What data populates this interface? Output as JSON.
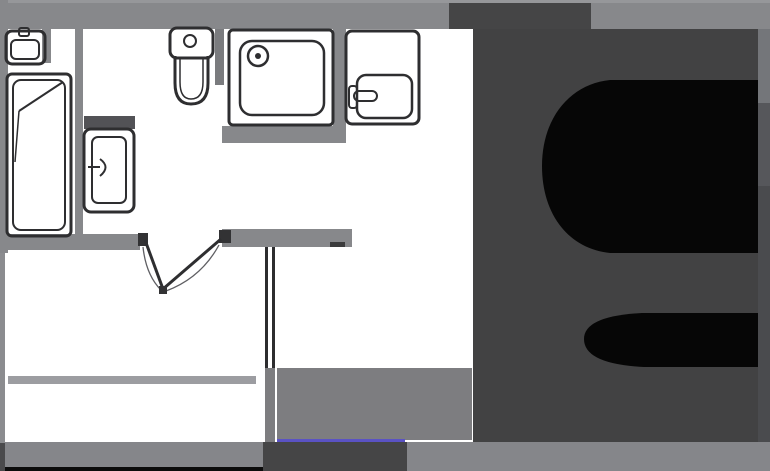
{
  "canvas": {
    "width": 770,
    "height": 471,
    "background": "#ffffff"
  },
  "plan": {
    "description": "apartment-floor-plan",
    "stroke_color": "#2e2e30",
    "accent_color": "#5a52c4",
    "wall_color": "#87888b",
    "overlay_color": "#424243",
    "glyph_color": "#060606"
  },
  "shapes": [
    {
      "name": "top-wall",
      "t": "rect",
      "x": 0,
      "y": 0,
      "w": 770,
      "h": 29,
      "f": "#87888b"
    },
    {
      "name": "top-wall-edge",
      "t": "rect",
      "x": 0,
      "y": 0,
      "w": 770,
      "h": 3,
      "f": "#96979a"
    },
    {
      "name": "left-wall-upper",
      "t": "rect",
      "x": 0,
      "y": 0,
      "w": 8,
      "h": 253,
      "f": "#87888b"
    },
    {
      "name": "left-wall-lower",
      "t": "rect",
      "x": 0,
      "y": 253,
      "w": 5,
      "h": 190,
      "f": "#8b8c8f"
    },
    {
      "name": "left-wall-corner-dark",
      "t": "rect",
      "x": 0,
      "y": 443,
      "w": 5,
      "h": 28,
      "f": "#4a4a4c"
    },
    {
      "name": "basin-wall-stub",
      "t": "rect",
      "x": 42,
      "y": 29,
      "w": 9,
      "h": 34,
      "f": "#87888b"
    },
    {
      "name": "bath-kitchen-divider-wall",
      "t": "rect",
      "x": 75,
      "y": 29,
      "w": 8,
      "h": 207,
      "f": "#87888b"
    },
    {
      "name": "washer-back-band",
      "t": "rect",
      "x": 84,
      "y": 116,
      "w": 51,
      "h": 13,
      "f": "#525256"
    },
    {
      "name": "toilet-wall-stub",
      "t": "rect",
      "x": 215,
      "y": 29,
      "w": 9,
      "h": 56,
      "f": "#7a7b7e"
    },
    {
      "name": "shower-side-wall",
      "t": "rect",
      "x": 333,
      "y": 29,
      "w": 13,
      "h": 114,
      "f": "#87888b"
    },
    {
      "name": "under-shower-wall",
      "t": "rect",
      "x": 222,
      "y": 126,
      "w": 124,
      "h": 17,
      "f": "#87888b"
    },
    {
      "name": "bathroom-bottom-wall",
      "t": "rect",
      "x": 0,
      "y": 234,
      "w": 140,
      "h": 16,
      "f": "#87888b"
    },
    {
      "name": "hall-bottom-wall",
      "t": "rect",
      "x": 222,
      "y": 229,
      "w": 130,
      "h": 18,
      "f": "#87888b"
    },
    {
      "name": "hall-wall-end-cap",
      "t": "rect",
      "x": 330,
      "y": 242,
      "w": 15,
      "h": 5,
      "f": "#3b3b3c"
    },
    {
      "name": "right-wall-upper",
      "t": "rect",
      "x": 758,
      "y": 29,
      "w": 12,
      "h": 74,
      "f": "#74767a"
    },
    {
      "name": "right-wall-mid",
      "t": "rect",
      "x": 758,
      "y": 103,
      "w": 12,
      "h": 83,
      "f": "#56575b"
    },
    {
      "name": "right-wall-lower",
      "t": "rect",
      "x": 758,
      "y": 186,
      "w": 12,
      "h": 256,
      "f": "#4a4b4e"
    },
    {
      "name": "balcony-divider-strip",
      "t": "rect",
      "x": 8,
      "y": 376,
      "w": 248,
      "h": 8,
      "f": "#9c9da1"
    },
    {
      "name": "bottom-edge-black-strip",
      "t": "rect",
      "x": 5,
      "y": 467,
      "w": 260,
      "h": 4,
      "f": "#0c0c0c"
    },
    {
      "name": "bottom-wall-left",
      "t": "rect",
      "x": 5,
      "y": 442,
      "w": 258,
      "h": 25,
      "f": "#85868a"
    },
    {
      "name": "bottom-dark-block",
      "t": "rect",
      "x": 263,
      "y": 442,
      "w": 144,
      "h": 29,
      "f": "#454546"
    },
    {
      "name": "bottom-wall-right",
      "t": "rect",
      "x": 407,
      "y": 442,
      "w": 363,
      "h": 29,
      "f": "#85868a"
    },
    {
      "name": "balcony-white-square",
      "t": "rect",
      "x": 5,
      "y": 420,
      "w": 11,
      "h": 18,
      "f": "#ffffff"
    },
    {
      "name": "open-door-leaf-white",
      "t": "rect",
      "x": 84,
      "y": 30,
      "w": 9,
      "h": 42,
      "f": "#ffffff"
    },
    {
      "name": "room-divider-line-a",
      "t": "rect",
      "x": 265,
      "y": 247,
      "w": 3,
      "h": 121,
      "f": "#2d2d2f"
    },
    {
      "name": "room-divider-line-b",
      "t": "rect",
      "x": 272,
      "y": 247,
      "w": 3,
      "h": 121,
      "f": "#2d2d2f"
    },
    {
      "name": "divider-gray-column",
      "t": "rect",
      "x": 265,
      "y": 368,
      "w": 10,
      "h": 74,
      "f": "#7d7d80"
    },
    {
      "name": "floor-patch",
      "t": "rect",
      "x": 277,
      "y": 368,
      "w": 195,
      "h": 72,
      "f": "#7d7d80"
    },
    {
      "name": "blue-accent-line",
      "t": "rect",
      "x": 277,
      "y": 439,
      "w": 128,
      "h": 3,
      "f": "#5a52c4"
    },
    {
      "name": "door-jamb-left",
      "t": "rect",
      "x": 138,
      "y": 233,
      "w": 10,
      "h": 13,
      "f": "#323234"
    },
    {
      "name": "door-jamb-right",
      "t": "rect",
      "x": 219,
      "y": 230,
      "w": 12,
      "h": 13,
      "f": "#323234"
    },
    {
      "name": "door-leaf-left",
      "t": "line",
      "x1": 145,
      "y1": 240,
      "x2": 163,
      "y2": 289,
      "s": "#2e2e30",
      "sw": 3
    },
    {
      "name": "door-leaf-right",
      "t": "line",
      "x1": 221,
      "y1": 239,
      "x2": 163,
      "y2": 289,
      "s": "#2e2e30",
      "sw": 3
    },
    {
      "name": "door-swing-arc-left",
      "t": "path",
      "d": "M143,247 Q146,275 161,290",
      "s": "#5f5f63",
      "sw": 1.3
    },
    {
      "name": "door-swing-arc-right",
      "t": "path",
      "d": "M219,245 Q201,278 166,291",
      "s": "#5f5f63",
      "sw": 1.3
    },
    {
      "name": "door-meeting-dot",
      "t": "rect",
      "x": 159,
      "y": 286,
      "w": 8,
      "h": 8,
      "f": "#323234"
    },
    {
      "name": "basin-outer",
      "t": "rrect",
      "x": 6,
      "y": 31,
      "w": 39,
      "h": 33,
      "r": 6,
      "s": "#2e2e30",
      "sw": 3
    },
    {
      "name": "basin-bowl",
      "t": "rrect",
      "x": 11,
      "y": 40,
      "w": 28,
      "h": 19,
      "r": 5,
      "s": "#2e2e30",
      "sw": 2
    },
    {
      "name": "basin-faucet",
      "t": "rrect",
      "x": 19,
      "y": 28,
      "w": 10,
      "h": 8,
      "r": 2,
      "s": "#2e2e30",
      "sw": 2
    },
    {
      "name": "bathtub-outer",
      "t": "rrect",
      "x": 7,
      "y": 74,
      "w": 64,
      "h": 162,
      "r": 5,
      "s": "#2e2e30",
      "sw": 3
    },
    {
      "name": "bathtub-inner",
      "t": "rrect",
      "x": 13,
      "y": 80,
      "w": 52,
      "h": 150,
      "r": 8,
      "s": "#2e2e30",
      "sw": 2
    },
    {
      "name": "bathtub-slope-line",
      "t": "line",
      "x1": 63,
      "y1": 82,
      "x2": 19,
      "y2": 111,
      "s": "#2e2e30",
      "sw": 2
    },
    {
      "name": "bathtub-slope-line-2",
      "t": "line",
      "x1": 19,
      "y1": 111,
      "x2": 15,
      "y2": 162,
      "s": "#2e2e30",
      "sw": 1.5
    },
    {
      "name": "washer-outer",
      "t": "rrect",
      "x": 84,
      "y": 129,
      "w": 50,
      "h": 83,
      "r": 7,
      "s": "#2e2e30",
      "sw": 3
    },
    {
      "name": "washer-inner",
      "t": "rrect",
      "x": 92,
      "y": 137,
      "w": 34,
      "h": 66,
      "r": 6,
      "s": "#2e2e30",
      "sw": 2
    },
    {
      "name": "washer-door-detail",
      "t": "path",
      "d": "M88,167 L100,167 M100,159 Q111,167 100,176",
      "s": "#2e2e30",
      "sw": 2
    },
    {
      "name": "toilet-tank",
      "t": "rrect",
      "x": 170,
      "y": 28,
      "w": 43,
      "h": 30,
      "r": 7,
      "s": "#2e2e30",
      "sw": 3
    },
    {
      "name": "toilet-button",
      "t": "circle",
      "cx": 190,
      "cy": 41,
      "r": 6,
      "s": "#2e2e30",
      "sw": 2
    },
    {
      "name": "toilet-bowl",
      "t": "path",
      "d": "M175,56 L175,83 Q175,104 191,104 Q208,104 208,83 L208,56",
      "s": "#2e2e30",
      "sw": 3
    },
    {
      "name": "toilet-bowl-inner",
      "t": "path",
      "d": "M180,58 L180,82 Q180,99 191,99 Q203,99 203,82 L203,58",
      "s": "#2e2e30",
      "sw": 1.5
    },
    {
      "name": "shower-outer",
      "t": "rrect",
      "x": 229,
      "y": 30,
      "w": 104,
      "h": 95,
      "r": 4,
      "s": "#2e2e30",
      "sw": 3
    },
    {
      "name": "shower-inner",
      "t": "rrect",
      "x": 240,
      "y": 41,
      "w": 84,
      "h": 74,
      "r": 12,
      "s": "#2e2e30",
      "sw": 2.5
    },
    {
      "name": "shower-drain-circle",
      "t": "circle",
      "cx": 258,
      "cy": 56,
      "r": 10,
      "s": "#2e2e30",
      "sw": 2.5
    },
    {
      "name": "shower-drain-dot",
      "t": "circle",
      "cx": 258,
      "cy": 56,
      "r": 3,
      "f": "#2e2e30"
    },
    {
      "name": "kitchen-sink-outer",
      "t": "rrect",
      "x": 346,
      "y": 31,
      "w": 73,
      "h": 93,
      "r": 6,
      "s": "#2e2e30",
      "sw": 3
    },
    {
      "name": "kitchen-sink-basin",
      "t": "rrect",
      "x": 357,
      "y": 75,
      "w": 55,
      "h": 43,
      "r": 9,
      "s": "#2e2e30",
      "sw": 2.5
    },
    {
      "name": "kitchen-sink-tap",
      "t": "rrect",
      "x": 349,
      "y": 86,
      "w": 8,
      "h": 22,
      "r": 3,
      "s": "#2e2e30",
      "sw": 2
    },
    {
      "name": "kitchen-sink-tap-arm",
      "t": "rrect",
      "x": 354,
      "y": 91,
      "w": 23,
      "h": 10,
      "r": 5,
      "s": "#2e2e30",
      "sw": 2
    },
    {
      "name": "overlay-top-tab",
      "t": "rect",
      "x": 449,
      "y": 3,
      "w": 142,
      "h": 26,
      "f": "#454546"
    },
    {
      "name": "overlay-square",
      "t": "rect",
      "x": 473,
      "y": 29,
      "w": 285,
      "h": 413,
      "f": "#424243"
    },
    {
      "name": "glyph-upper-counter",
      "t": "path",
      "d": "M758,80 L610,80 C570,84 542,118 542,166 C542,216 570,249 610,253 L758,253 Z",
      "f": "#060606"
    },
    {
      "name": "glyph-lower-counter",
      "t": "path",
      "d": "M758,313 L642,313 Q584,316 584,339 Q584,364 644,367 L758,367 Z",
      "f": "#060606"
    }
  ]
}
